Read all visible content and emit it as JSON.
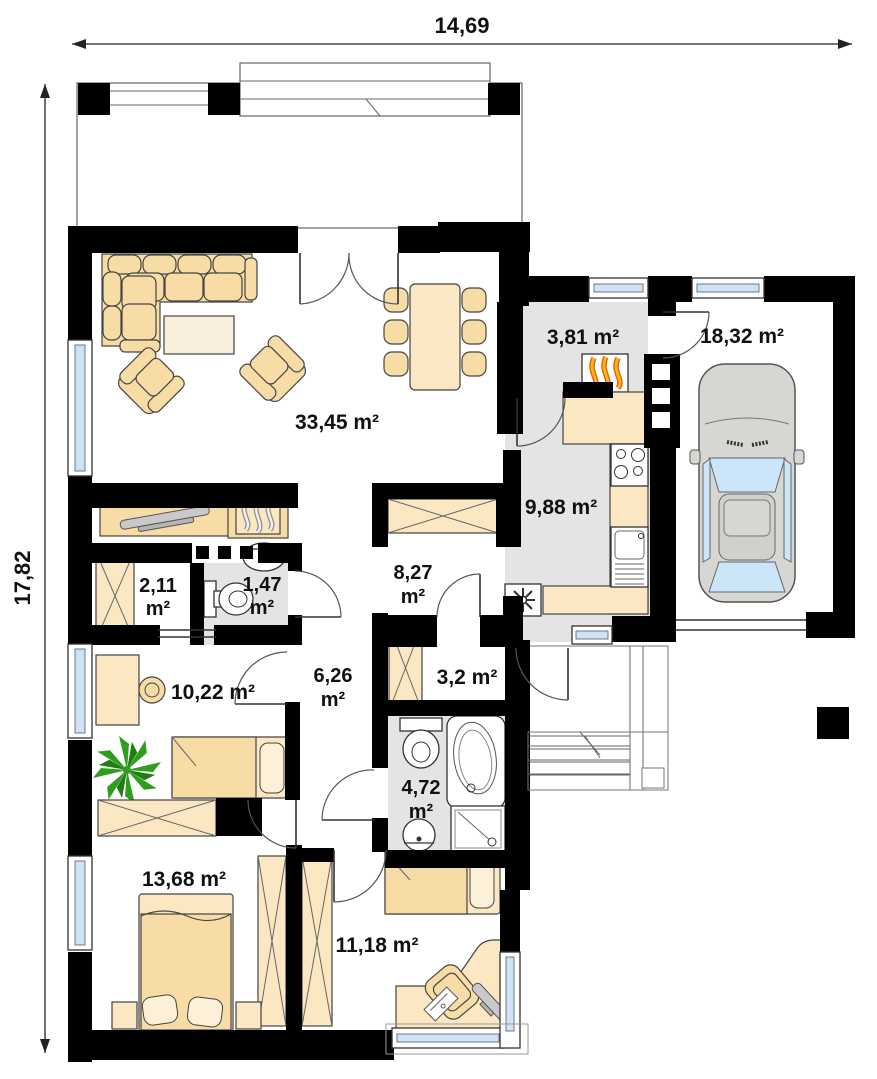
{
  "title": "single-storey house floor plan",
  "dimensions": {
    "width_label": "14,69",
    "height_label": "17,82"
  },
  "rooms": {
    "living": {
      "label": "33,45 m²"
    },
    "boiler": {
      "label": "3,81 m²"
    },
    "garage": {
      "label": "18,32 m²"
    },
    "kitchen": {
      "label": "9,88 m²"
    },
    "closet": {
      "line1": "2,11",
      "line2": "m²"
    },
    "wc": {
      "line1": "1,47",
      "line2": "m²"
    },
    "hall": {
      "line1": "8,27",
      "line2": "m²"
    },
    "bedroom_left": {
      "label": "10,22 m²"
    },
    "corridor": {
      "line1": "6,26",
      "line2": "m²"
    },
    "wardrobe_room": {
      "label": "3,2 m²"
    },
    "bathroom": {
      "line1": "4,72",
      "line2": "m²"
    },
    "bedroom_bottom_left": {
      "label": "13,68 m²"
    },
    "bedroom_bottom_right": {
      "label": "11,18 m²"
    }
  },
  "icons": {
    "boiler_unit": "flame-icon",
    "fireplace": "smoke-flame-icon",
    "fridge_vent": "snowflake-icon"
  },
  "colors": {
    "wall": "#000000",
    "floor_tile": "#e4e4e4",
    "furniture": "#f8dca6",
    "furniture_light": "#fbe7c2",
    "window_glass": "#cfe3f5",
    "flame_orange": "#f29100",
    "plant_green": "#2f9e1f",
    "car_body": "#d6d6d2",
    "car_glass": "#cbe6f8",
    "label_text": "#111111"
  }
}
